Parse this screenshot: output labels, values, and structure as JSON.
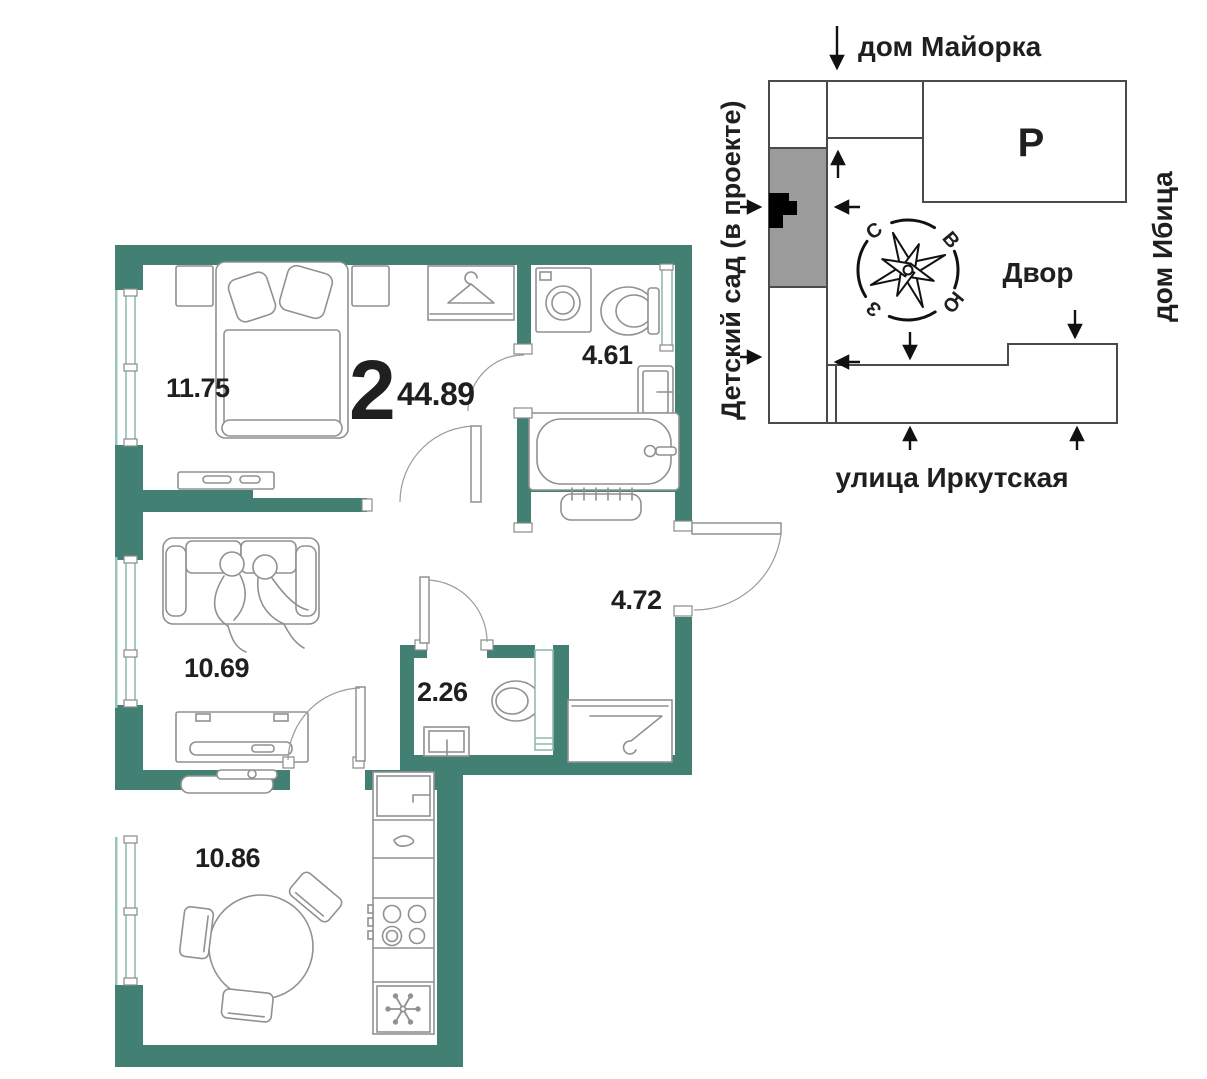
{
  "plan": {
    "unit": {
      "rooms_count": "2",
      "total_area": "44.89"
    },
    "rooms": {
      "bedroom": "11.75",
      "bathroom": "4.61",
      "living": "10.69",
      "wc": "2.26",
      "hallway": "4.72",
      "kitchen": "10.86"
    }
  },
  "site_plan": {
    "top_label": "дом Майорка",
    "left_label": "Детский сад (в проекте)",
    "right_label": "дом Ибица",
    "bottom_label": "улица Иркутская",
    "courtyard_label": "Двор",
    "parking_label": "Р",
    "compass": {
      "n": "С",
      "e": "В",
      "s": "Ю",
      "w": "З"
    }
  },
  "colors": {
    "wall_accent": "#418073",
    "site_gray": "#9b9b9b"
  }
}
